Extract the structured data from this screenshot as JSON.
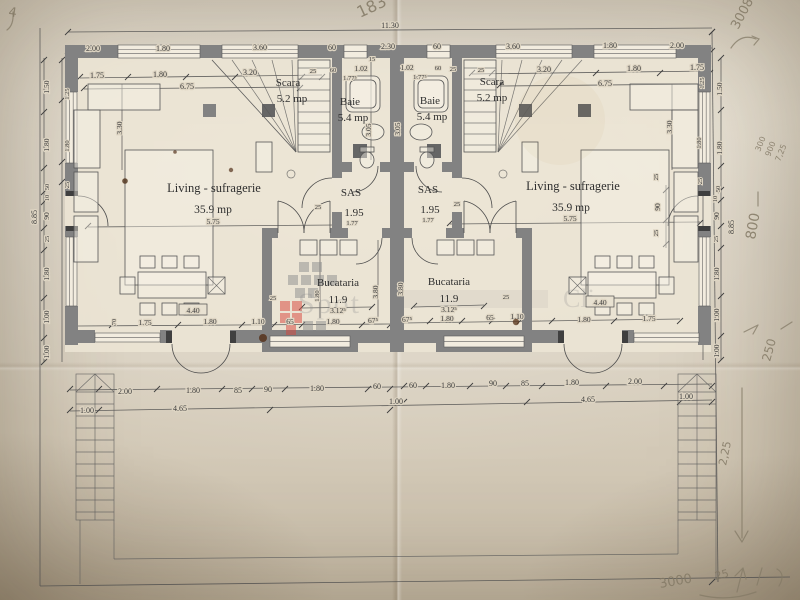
{
  "watermark": {
    "text": "Spot",
    "fragment": "Cli"
  },
  "rooms": {
    "left": {
      "living": "Living - sufragerie",
      "living_area": "35.9 mp",
      "scara": "Scara",
      "scara_area": "5.2 mp",
      "baie": "Baie",
      "baie_area": "5.4 mp",
      "sas": "SAS",
      "sas_area": "1.95",
      "bucataria": "Bucataria",
      "bucataria_area": "11.9"
    },
    "right": {
      "living": "Living - sufragerie",
      "living_area": "35.9 mp",
      "scara": "Scara",
      "scara_area": "5.2 mp",
      "baie": "Baie",
      "baie_area": "5.4 mp",
      "sas": "SAS",
      "sas_area": "1.95",
      "bucataria": "Bucataria",
      "bucataria_area": "11.9"
    }
  },
  "dims": {
    "overall_width": "11.30",
    "top": [
      "2.00",
      "1.80",
      "3.60",
      "60",
      "2.30",
      "60",
      "3.60",
      "1.80",
      "2.00"
    ],
    "upper_left": [
      "1.75",
      "1.80",
      "3.20",
      "25"
    ],
    "upper_left_total": "6.75",
    "upper_right": [
      "25",
      "3.20",
      "1.80",
      "1.75"
    ],
    "upper_right_total": "6.75",
    "bath": [
      "60",
      "1.02",
      "15",
      "1.77⁵",
      "1.02",
      "60",
      "25",
      "1.77⁵",
      "3.05",
      "3.05"
    ],
    "living_width": "5.75",
    "sas_small": [
      "25",
      "1.77",
      "25",
      "1.77"
    ],
    "vert": [
      "3.30",
      "3.30",
      "1.80",
      "3.80",
      "3.80",
      "70"
    ],
    "kitchen_left": [
      "65",
      "1.80",
      "67⁵",
      "25",
      "3.12⁵"
    ],
    "kitchen_right": [
      "67⁵",
      "1.80",
      "65",
      "1.10",
      "25",
      "3.12⁵"
    ],
    "dining_left": [
      "1.75",
      "1.80",
      "1.10",
      "4.40"
    ],
    "dining_right": [
      "1.80",
      "1.75",
      "4.40"
    ],
    "door_right": [
      "25",
      "90",
      "25"
    ],
    "margin_left": [
      "1.50",
      "1.80",
      "50",
      "10",
      "90",
      "25",
      "1.80",
      "1.00",
      "1.00"
    ],
    "margin_left_total": "8.85",
    "margin_left_inner": [
      "1.25",
      "1.80",
      "25"
    ],
    "margin_right": [
      "1.50",
      "1.80",
      "50",
      "10",
      "90",
      "25",
      "1.80",
      "1.00",
      "1.00"
    ],
    "margin_right_total": "8.85",
    "margin_right_inner": [
      "1.25",
      "1.80",
      "25"
    ],
    "bottom_left": [
      "2.00",
      "1.80",
      "85",
      "90",
      "1.80",
      "60"
    ],
    "bottom_right": [
      "60",
      "1.80",
      "90",
      "85",
      "1.80",
      "2.00"
    ],
    "bottom2": [
      "1.00",
      "4.65",
      "1.00",
      "4.65",
      "1.00"
    ]
  },
  "handwritten": {
    "top_left": "4",
    "top_center": "183",
    "top_right": "3008",
    "right_notes": [
      "300",
      "900",
      "7,25"
    ],
    "right_mid": "800",
    "right_lower": "250",
    "right_arrow": "2,25",
    "bottom_notes": [
      "3000",
      "25"
    ]
  }
}
